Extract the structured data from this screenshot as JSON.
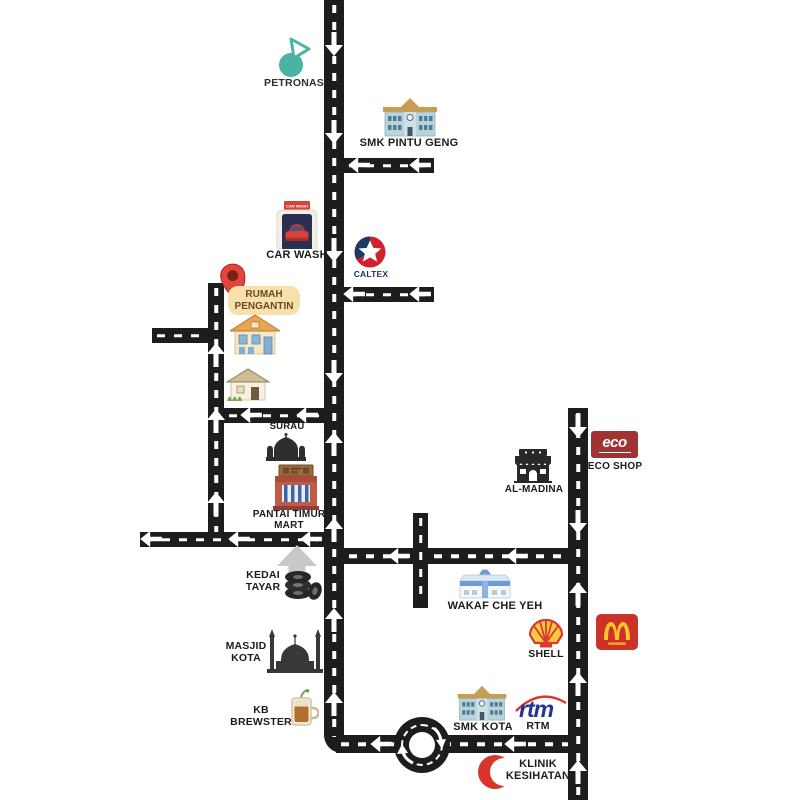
{
  "map": {
    "destination": "RUMAH PENGANTIN"
  },
  "landmarks": {
    "petronas": {
      "label": "PETRONAS"
    },
    "smk_pintu_geng": {
      "label": "SMK PINTU GENG"
    },
    "car_wash": {
      "label": "CAR WASH",
      "sign_text": "CAR WASH"
    },
    "caltex": {
      "label": "CALTEX"
    },
    "rumah_pengantin": {
      "line1": "RUMAH",
      "line2": "PENGANTIN"
    },
    "surau": {
      "label": "SURAU"
    },
    "pantai_timur_mart": {
      "line1": "PANTAI TIMUR",
      "line2": "MART"
    },
    "kedai_tayar": {
      "line1": "KEDAI",
      "line2": "TAYAR"
    },
    "masjid_kota": {
      "line1": "MASJID",
      "line2": "KOTA"
    },
    "kb_brewster": {
      "line1": "KB",
      "line2": "BREWSTER"
    },
    "al_madina": {
      "label": "AL-MADINA"
    },
    "eco_shop": {
      "logo_text": "eco",
      "label": "ECO SHOP"
    },
    "wakaf_che_yeh": {
      "label": "WAKAF CHE YEH"
    },
    "shell": {
      "label": "SHELL"
    },
    "smk_kota": {
      "label": "SMK KOTA"
    },
    "rtm": {
      "logo_text": "rtm",
      "label": "RTM"
    },
    "klinik_kesihatan": {
      "line1": "KLINIK",
      "line2": "KESIHATAN"
    }
  },
  "colors": {
    "road": "#1d1d1d",
    "road_marking": "#ffffff",
    "petronas_teal": "#4ab3a4",
    "caltex_navy": "#1d3a66",
    "caltex_red": "#cf2030",
    "pin_red": "#e2453c",
    "bubble_yellow": "#f8e0ad",
    "eco_red": "#a03434",
    "shell_yellow": "#f9c940",
    "shell_red": "#d93a32",
    "mcdonalds_red": "#cd3227",
    "mcdonalds_yellow": "#fec52e",
    "rtm_blue": "#24338f",
    "crescent_red": "#d8352c",
    "pointer_gray": "#c9c9c9"
  }
}
